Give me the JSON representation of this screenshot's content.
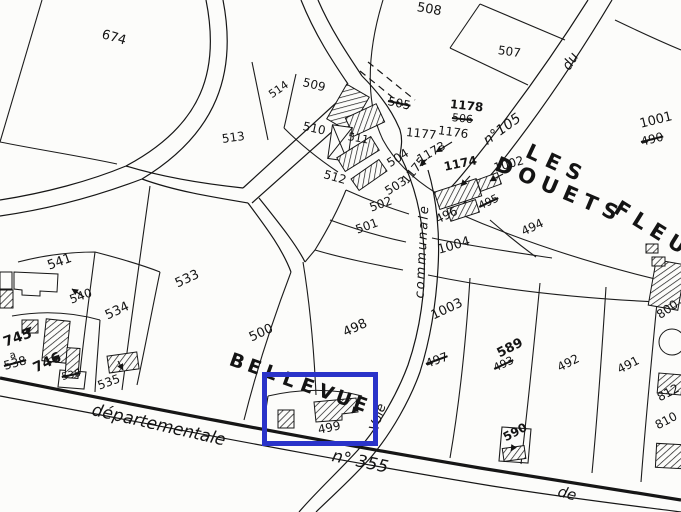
{
  "map": {
    "title": "cadastral-plan-extract",
    "background": "#fcfcfa",
    "ink_color": "#1c1c1c",
    "highlight": {
      "color": "#2a33c9",
      "x": 262,
      "y": 372,
      "w": 116,
      "h": 74,
      "target_parcel": "499"
    },
    "labels": [
      {
        "text": "674",
        "kind": "parcel",
        "x": 102,
        "y": 28,
        "rot": 16,
        "size": 13
      },
      {
        "text": "508",
        "kind": "parcel",
        "x": 417,
        "y": 1,
        "rot": 10,
        "size": 13
      },
      {
        "text": "507",
        "kind": "parcel",
        "x": 498,
        "y": 44,
        "rot": 8,
        "size": 12
      },
      {
        "text": "513",
        "kind": "parcel",
        "x": 222,
        "y": 133,
        "rot": -8,
        "size": 12
      },
      {
        "text": "514",
        "kind": "parcel",
        "x": 270,
        "y": 90,
        "rot": -35,
        "size": 11
      },
      {
        "text": "509",
        "kind": "parcel",
        "x": 303,
        "y": 76,
        "rot": 14,
        "size": 12
      },
      {
        "text": "510",
        "kind": "parcel",
        "x": 303,
        "y": 120,
        "rot": 12,
        "size": 12
      },
      {
        "text": "511",
        "kind": "parcel",
        "x": 348,
        "y": 131,
        "rot": 10,
        "size": 11
      },
      {
        "text": "512",
        "kind": "parcel",
        "x": 324,
        "y": 168,
        "rot": 16,
        "size": 12
      },
      {
        "text": "505",
        "kind": "parcel-old",
        "x": 388,
        "y": 95,
        "rot": 12,
        "size": 12,
        "struck": true
      },
      {
        "text": "1178",
        "kind": "parcel",
        "x": 450,
        "y": 98,
        "rot": 6,
        "size": 12,
        "bold": true
      },
      {
        "text": "506",
        "kind": "parcel-old",
        "x": 452,
        "y": 112,
        "rot": 6,
        "size": 11,
        "struck": true
      },
      {
        "text": "1177",
        "kind": "parcel",
        "x": 406,
        "y": 126,
        "rot": 6,
        "size": 12
      },
      {
        "text": "1176",
        "kind": "parcel",
        "x": 438,
        "y": 124,
        "rot": 8,
        "size": 12
      },
      {
        "text": "1173",
        "kind": "parcel",
        "x": 418,
        "y": 154,
        "rot": -30,
        "size": 12
      },
      {
        "text": "1174",
        "kind": "parcel",
        "x": 444,
        "y": 161,
        "rot": -12,
        "size": 12,
        "bold": true
      },
      {
        "text": "1175",
        "kind": "parcel",
        "x": 404,
        "y": 176,
        "rot": -50,
        "size": 12
      },
      {
        "text": "504",
        "kind": "parcel",
        "x": 388,
        "y": 158,
        "rot": -32,
        "size": 12
      },
      {
        "text": "503",
        "kind": "parcel",
        "x": 386,
        "y": 186,
        "rot": -32,
        "size": 12
      },
      {
        "text": "502",
        "kind": "parcel",
        "x": 370,
        "y": 202,
        "rot": -20,
        "size": 12
      },
      {
        "text": "501",
        "kind": "parcel",
        "x": 356,
        "y": 224,
        "rot": -20,
        "size": 12
      },
      {
        "text": "1002",
        "kind": "parcel",
        "x": 494,
        "y": 162,
        "rot": -15,
        "size": 12
      },
      {
        "text": "495",
        "kind": "parcel-old",
        "x": 479,
        "y": 201,
        "rot": -25,
        "size": 11,
        "struck": true
      },
      {
        "text": "496",
        "kind": "parcel",
        "x": 436,
        "y": 214,
        "rot": -25,
        "size": 12
      },
      {
        "text": "494",
        "kind": "parcel",
        "x": 522,
        "y": 226,
        "rot": -25,
        "size": 12
      },
      {
        "text": "1004",
        "kind": "parcel",
        "x": 438,
        "y": 244,
        "rot": -16,
        "size": 13
      },
      {
        "text": "1001",
        "kind": "parcel",
        "x": 640,
        "y": 118,
        "rot": -14,
        "size": 13
      },
      {
        "text": "490",
        "kind": "parcel-old",
        "x": 641,
        "y": 136,
        "rot": -14,
        "size": 12,
        "struck": true
      },
      {
        "text": "1003",
        "kind": "parcel",
        "x": 432,
        "y": 310,
        "rot": -25,
        "size": 13
      },
      {
        "text": "497",
        "kind": "parcel-old",
        "x": 426,
        "y": 358,
        "rot": -20,
        "size": 12,
        "struck": true
      },
      {
        "text": "589",
        "kind": "parcel",
        "x": 498,
        "y": 348,
        "rot": -27,
        "size": 13,
        "bold": true
      },
      {
        "text": "493",
        "kind": "parcel-old",
        "x": 494,
        "y": 363,
        "rot": -25,
        "size": 11,
        "struck": true
      },
      {
        "text": "492",
        "kind": "parcel",
        "x": 558,
        "y": 362,
        "rot": -27,
        "size": 12
      },
      {
        "text": "491",
        "kind": "parcel",
        "x": 618,
        "y": 364,
        "rot": -27,
        "size": 12
      },
      {
        "text": "590",
        "kind": "parcel",
        "x": 504,
        "y": 432,
        "rot": -28,
        "size": 12,
        "bold": true
      },
      {
        "text": "500",
        "kind": "parcel",
        "x": 250,
        "y": 332,
        "rot": -25,
        "size": 13
      },
      {
        "text": "498",
        "kind": "parcel",
        "x": 344,
        "y": 327,
        "rot": -25,
        "size": 13
      },
      {
        "text": "499",
        "kind": "parcel",
        "x": 318,
        "y": 424,
        "rot": -12,
        "size": 12
      },
      {
        "text": "533",
        "kind": "parcel",
        "x": 176,
        "y": 278,
        "rot": -25,
        "size": 13
      },
      {
        "text": "535",
        "kind": "parcel",
        "x": 98,
        "y": 380,
        "rot": -20,
        "size": 12
      },
      {
        "text": "534",
        "kind": "parcel",
        "x": 106,
        "y": 310,
        "rot": -25,
        "size": 13
      },
      {
        "text": "541",
        "kind": "parcel",
        "x": 48,
        "y": 260,
        "rot": -20,
        "size": 13
      },
      {
        "text": "540",
        "kind": "parcel",
        "x": 70,
        "y": 294,
        "rot": -20,
        "size": 12
      },
      {
        "text": "745",
        "kind": "parcel",
        "x": 4,
        "y": 336,
        "rot": -20,
        "size": 14,
        "bold": true
      },
      {
        "text": "a",
        "kind": "parcel",
        "x": 10,
        "y": 352,
        "rot": -15,
        "size": 10
      },
      {
        "text": "538",
        "kind": "parcel-old",
        "x": 4,
        "y": 360,
        "rot": -15,
        "size": 12,
        "struck": true
      },
      {
        "text": "746",
        "kind": "parcel",
        "x": 34,
        "y": 362,
        "rot": -25,
        "size": 14,
        "bold": true
      },
      {
        "text": "536",
        "kind": "parcel-old",
        "x": 62,
        "y": 373,
        "rot": -12,
        "size": 10,
        "struck": true
      },
      {
        "text": "800",
        "kind": "parcel",
        "x": 658,
        "y": 310,
        "rot": -35,
        "size": 12
      },
      {
        "text": "812",
        "kind": "parcel",
        "x": 658,
        "y": 392,
        "rot": -28,
        "size": 12
      },
      {
        "text": "810",
        "kind": "parcel",
        "x": 656,
        "y": 420,
        "rot": -28,
        "size": 12
      },
      {
        "text": "départementale",
        "kind": "road",
        "x": 92,
        "y": 402,
        "rot": 13,
        "size": 17
      },
      {
        "text": "n° 355",
        "kind": "road",
        "x": 332,
        "y": 448,
        "rot": 12,
        "size": 17
      },
      {
        "text": "de",
        "kind": "road",
        "x": 558,
        "y": 484,
        "rot": 15,
        "size": 15
      },
      {
        "text": "Voie",
        "kind": "road",
        "x": 374,
        "y": 424,
        "rot": -72,
        "size": 13
      },
      {
        "text": "communale",
        "kind": "road",
        "x": 420,
        "y": 292,
        "rot": -87,
        "size": 13,
        "ls": 2
      },
      {
        "text": "du",
        "kind": "road",
        "x": 566,
        "y": 62,
        "rot": -58,
        "size": 14
      },
      {
        "text": "n°105",
        "kind": "road",
        "x": 485,
        "y": 135,
        "rot": -36,
        "size": 14
      },
      {
        "text": "LES",
        "kind": "place",
        "x": 527,
        "y": 140,
        "rot": 25,
        "size": 21,
        "ls": 8
      },
      {
        "text": "DOUETS",
        "kind": "place",
        "x": 496,
        "y": 153,
        "rot": 23,
        "size": 21,
        "ls": 7
      },
      {
        "text": "FLEU",
        "kind": "place",
        "x": 616,
        "y": 196,
        "rot": 32,
        "size": 21,
        "ls": 7
      },
      {
        "text": "BELLEVUE",
        "kind": "place",
        "x": 230,
        "y": 350,
        "rot": 20,
        "size": 19,
        "arc": {
          "dx": 17.7,
          "dy": 6.2
        }
      }
    ]
  }
}
